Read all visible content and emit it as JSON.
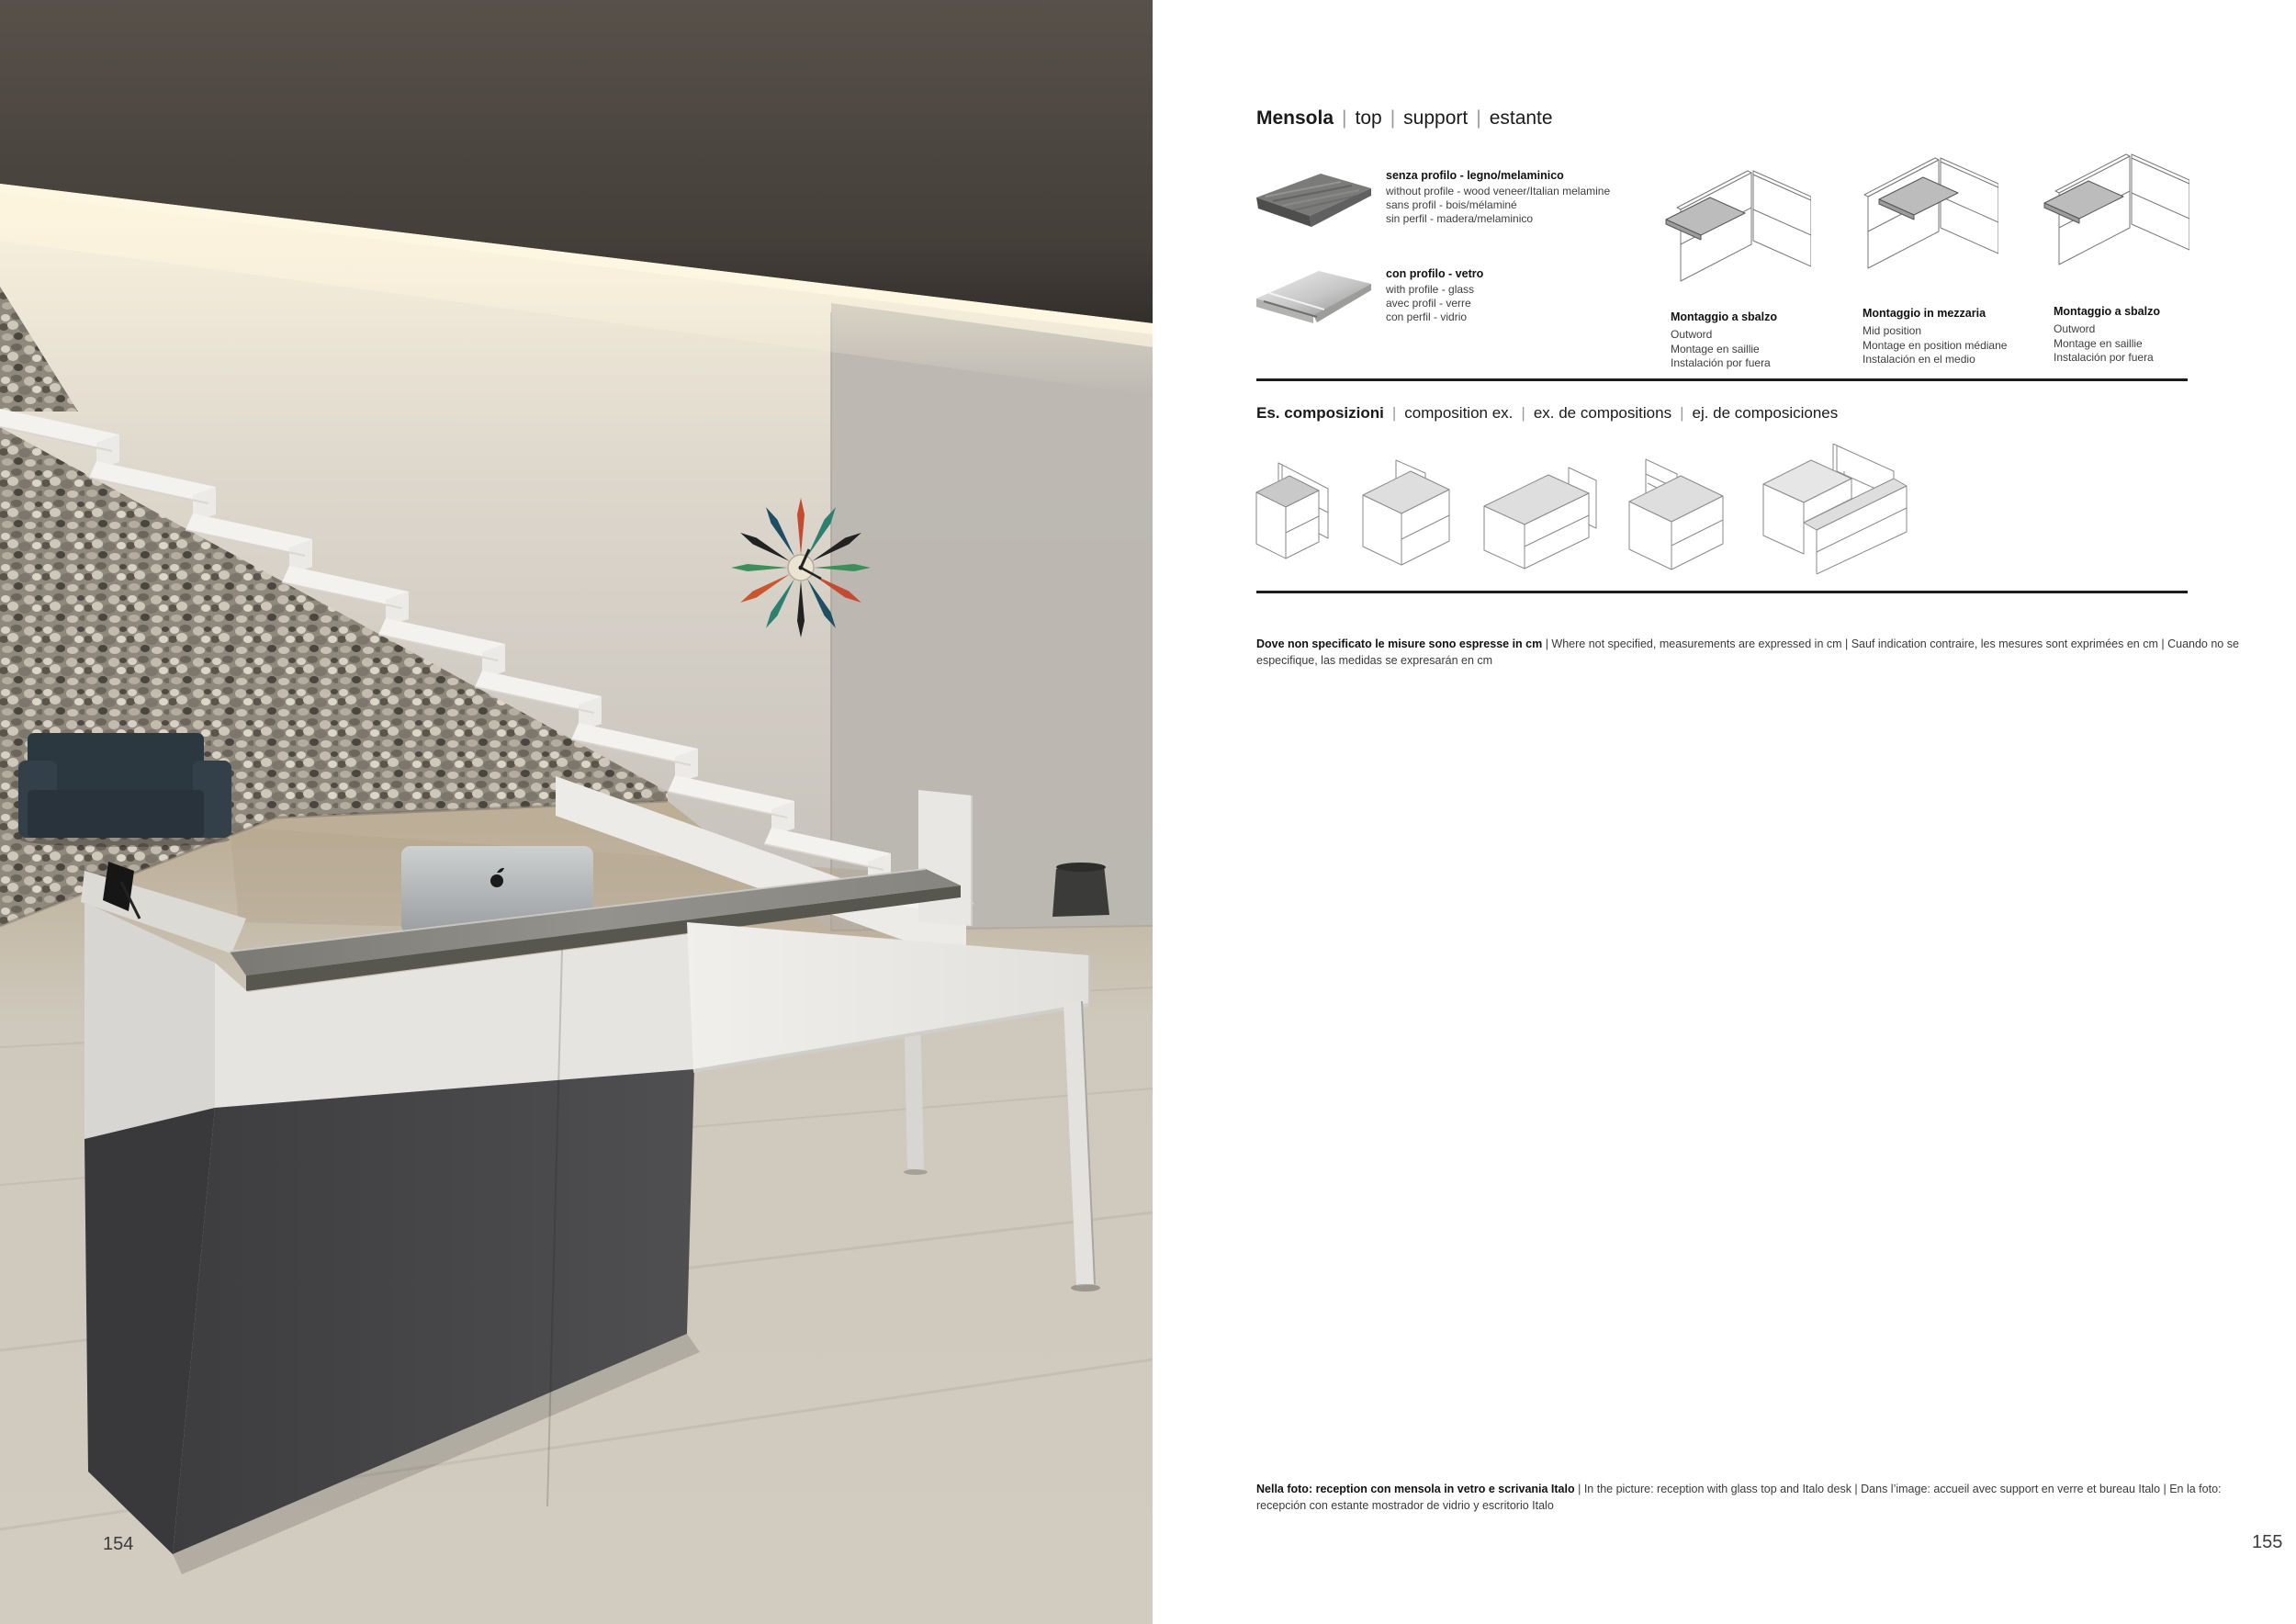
{
  "page_numbers": {
    "left": "154",
    "right": "155"
  },
  "sep": "|",
  "photo_description": "Reception area: dark ceiling with warm cove light strip, stone gabion wall with white floating staircase, starburst wall clock, dark armchair, reception desk with white and charcoal fronts, glass counter top with iMac, white Italo desk, travertine floor",
  "right_page": {
    "title": {
      "brand": "Mensola",
      "alt1": "top",
      "alt2": "support",
      "alt3": "estante"
    },
    "materials": [
      {
        "label": "senza profilo - legno/melaminico",
        "l1": "without profile - wood veneer/Italian melamine",
        "l2": "sans profil - bois/mélaminé",
        "l3": "sin perfil - madera/melaminico"
      },
      {
        "label": "con profilo - vetro",
        "l1": "with profile - glass",
        "l2": "avec profil - verre",
        "l3": "con perfil - vidrio"
      }
    ],
    "mountings": [
      {
        "title": "Montaggio a sbalzo",
        "l1": "Outword",
        "l2": "Montage en saillie",
        "l3": "Instalación por fuera"
      },
      {
        "title": "Montaggio in mezzaria",
        "l1": "Mid position",
        "l2": "Montage en position médiane",
        "l3": "Instalación en el medio"
      },
      {
        "title": "Montaggio a sbalzo",
        "l1": "Outword",
        "l2": "Montage en saillie",
        "l3": "Instalación por fuera"
      }
    ],
    "compositions_heading": {
      "brand": "Es. composizioni",
      "alt1": "composition ex.",
      "alt2": "ex. de compositions",
      "alt3": "ej. de composiciones"
    },
    "measure_note": {
      "bold": "Dove non specificato le misure sono espresse in cm",
      "rest": " | Where not specified, measurements are expressed in cm | Sauf indication contraire, les mesures sont exprimées en cm | Cuando no se especifique, las medidas se expresarán en cm"
    },
    "photo_caption": {
      "bold": "Nella foto: reception con mensola in vetro e scrivania Italo",
      "rest": " | In the picture: reception with glass top and Italo desk | Dans l’image: accueil avec support en verre et bureau Italo | En la foto: recepción con estante mostrador de vidrio y escritorio Italo"
    }
  },
  "colors": {
    "rule": "#1c1c1c",
    "body_text": "#3a3a3a",
    "shelf_gray": "#bcbcbc",
    "page_bg": "#ffffff"
  }
}
